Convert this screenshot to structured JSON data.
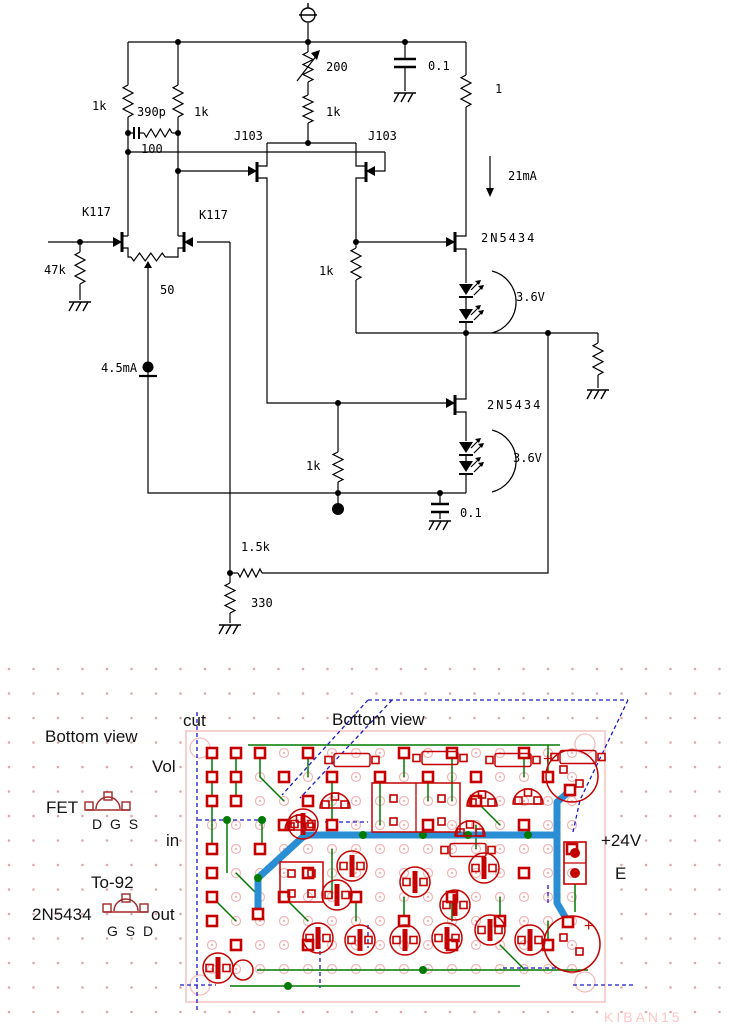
{
  "schematic": {
    "labels": {
      "r_top_left": "1k",
      "cap_ff": "390p",
      "r_ff": "100",
      "r_top_mid": "1k",
      "vr_source": "200",
      "r_source": "1k",
      "jfet_casc_left": "J103",
      "jfet_casc_right": "J103",
      "cap_rail": "0.1",
      "r_sense": "1",
      "i_drain": "21mA",
      "jfet_in_left": "K117",
      "jfet_in_right": "K117",
      "r_gate": "47k",
      "pot_bal": "50",
      "i_tail": "4.5mA",
      "r_gate_top": "1k",
      "q_out_top": "2N5434",
      "v_led_top": "3.6V",
      "q_out_bot": "2N5434",
      "v_led_bot": "3.6V",
      "r_gate_bot": "1k",
      "cap_out": "0.1",
      "r_fb": "1.5k",
      "r_shunt": "330"
    }
  },
  "pcb": {
    "labels": {
      "bottom_view_left": "Bottom view",
      "cut": "cut",
      "bottom_view_board": "Bottom view",
      "vol": "Vol",
      "fet": "FET",
      "fet_pins": "D G S",
      "in": "in",
      "to92": "To-92",
      "part": "2N5434",
      "out": "out",
      "part_pins": "G S D",
      "v_supply": "+24V",
      "e": "E",
      "plus_top": "+",
      "plus_bot": "+",
      "watermark": "KIBAN15"
    },
    "colors": {
      "trace_green": "#007a00",
      "pad_red": "#c40000",
      "glyph_red": "#a02828",
      "signal_blue": "#2a8ed5",
      "guide_blue": "#1a1acc",
      "hole_pink": "#f0b6b6",
      "board_pink": "#f4bdbd",
      "dot_pink": "#dfa8a8",
      "watermark_pink": "#ffc6c6"
    }
  }
}
